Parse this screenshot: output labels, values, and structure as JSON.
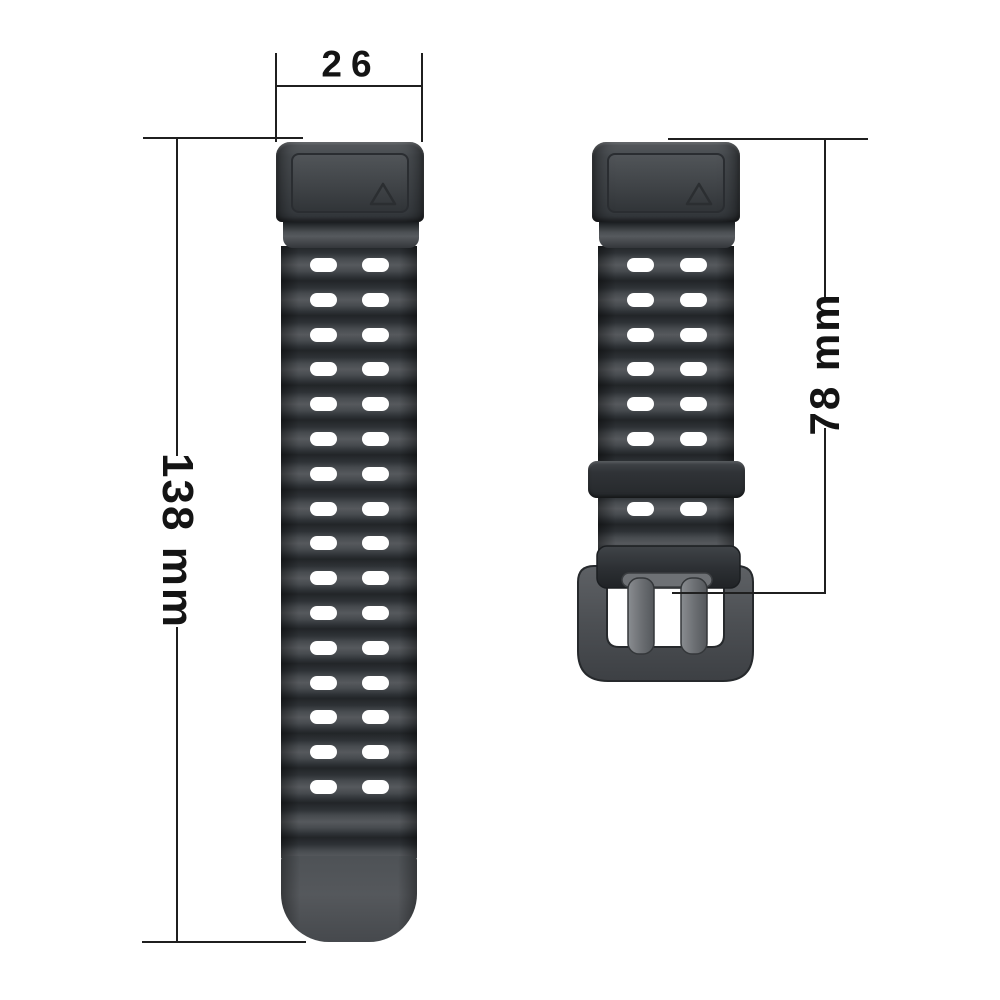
{
  "labels": {
    "lug_width": "26",
    "long_strap_length": "138 mm",
    "short_strap_length": "78 mm"
  },
  "colors": {
    "background": "#ffffff",
    "dimension_line": "#1f1f1f",
    "strap_base": "#3b3e42",
    "ridge_highlight": "#56595d",
    "ridge_shadow": "#222528",
    "hole": "#ffffff",
    "buckle_frame": "#54575b",
    "buckle_pin": "#7b7e82",
    "strap_fold": "#2d3034"
  },
  "geometry": {
    "long_strap_hole_rows": 16,
    "short_strap_hole_rows": 7,
    "holes_per_row": 2
  }
}
